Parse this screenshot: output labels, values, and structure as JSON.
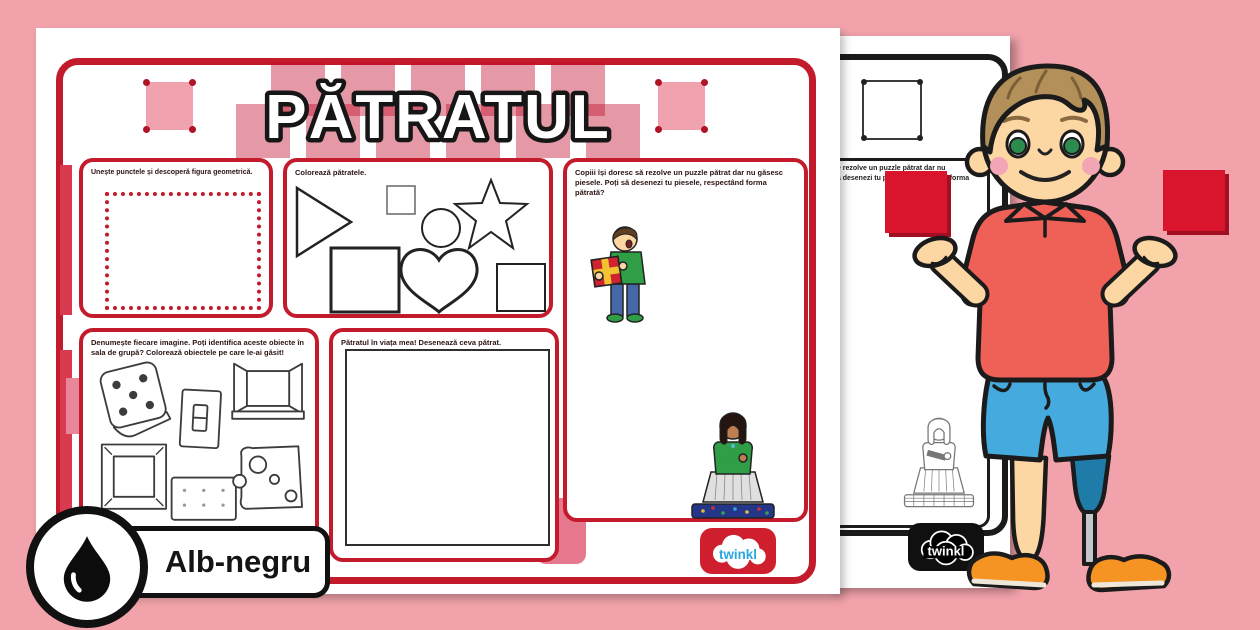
{
  "scene": {
    "background_color": "#f2a2aa",
    "accent_red": "#c41b2c"
  },
  "worksheet": {
    "title": "PĂTRATUL",
    "brand": "twinkl",
    "sections": {
      "connect_dots": {
        "instruction": "Unește punctele și descoperă figura geometrică."
      },
      "color_squares": {
        "instruction": "Colorează pătratele.",
        "shapes": [
          "triangle",
          "square",
          "circle",
          "star",
          "square",
          "heart",
          "square"
        ]
      },
      "puzzle": {
        "instruction": "Copiii își doresc să rezolve un puzzle pătrat dar nu găsesc piesele. Poți să desenezi tu piesele, respectând forma pătrată?"
      },
      "identify_objects": {
        "instruction": "Denumește fiecare imagine. Poți identifica aceste obiecte în sala de grupă? Colorează obiectele pe care le-ai găsit!",
        "objects": [
          "dice",
          "light-switch",
          "open-window",
          "picture-frame",
          "cracker",
          "cheese"
        ]
      },
      "draw_square": {
        "instruction": "Pătratul în viața mea! Desenează ceva pătrat."
      }
    }
  },
  "bw_page": {
    "visible_text_line1": "se rezolve un puzzle pătrat dar nu",
    "visible_text_line2": "să desenezi tu piesele, respectând forma",
    "brand": "twinkl"
  },
  "badge": {
    "label": "Alb-negru"
  }
}
